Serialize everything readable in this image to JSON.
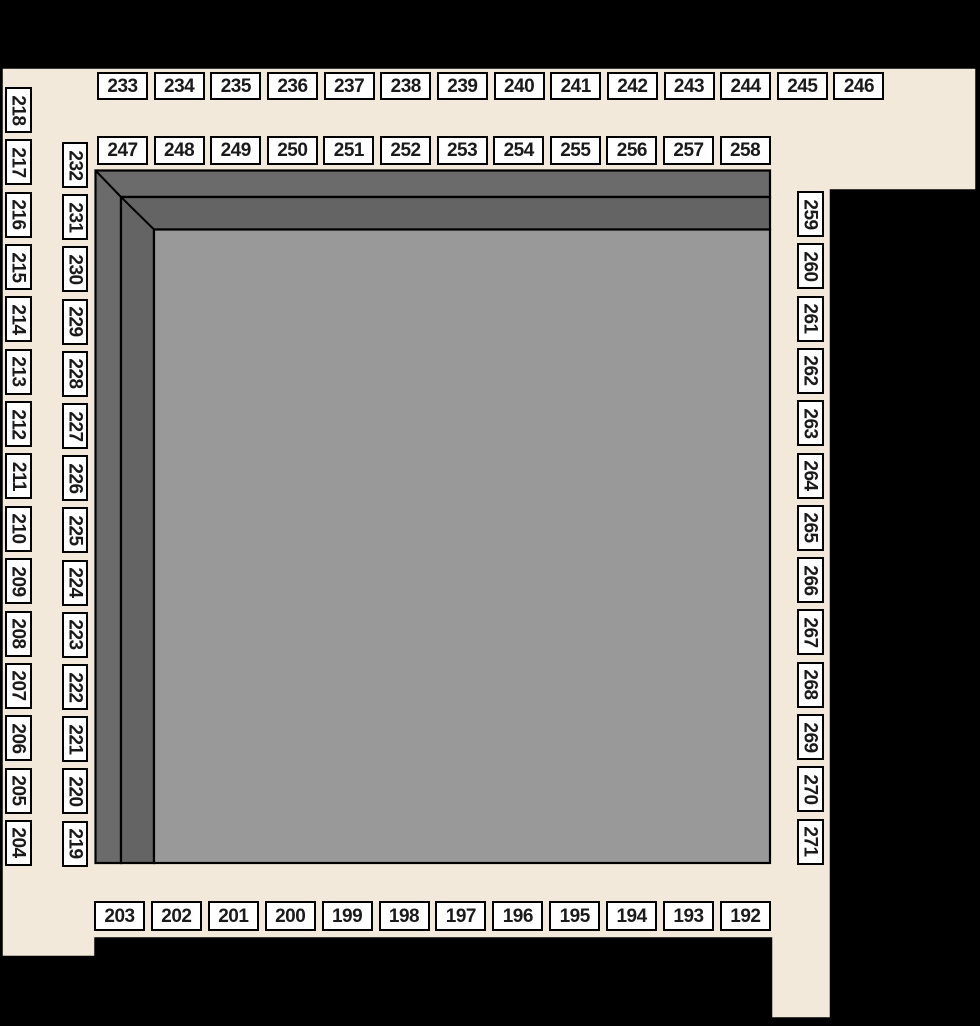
{
  "map_title": "venue-seating-map",
  "colors": {
    "background": "#000000",
    "concourse": "#f2e9da",
    "section_fill": "#ffffff",
    "section_border": "#000000",
    "section_text": "#1a1a1a",
    "wall_outer": "#6b6b6b",
    "wall_inner": "#646464",
    "field": "#999999",
    "outline": "#000000"
  },
  "sections": {
    "top_outer_row": {
      "labels": [
        "233",
        "234",
        "235",
        "236",
        "237",
        "238",
        "239",
        "240",
        "241",
        "242",
        "243",
        "244",
        "245",
        "246"
      ]
    },
    "top_inner_row": {
      "labels": [
        "247",
        "248",
        "249",
        "250",
        "251",
        "252",
        "253",
        "254",
        "255",
        "256",
        "257",
        "258"
      ]
    },
    "left_outer_column": {
      "labels": [
        "218",
        "217",
        "216",
        "215",
        "214",
        "213",
        "212",
        "211",
        "210",
        "209",
        "208",
        "207",
        "206",
        "205",
        "204"
      ]
    },
    "left_inner_column": {
      "labels": [
        "232",
        "231",
        "230",
        "229",
        "228",
        "227",
        "226",
        "225",
        "224",
        "223",
        "222",
        "221",
        "220",
        "219"
      ]
    },
    "right_column": {
      "labels": [
        "259",
        "260",
        "261",
        "262",
        "263",
        "264",
        "265",
        "266",
        "267",
        "268",
        "269",
        "270",
        "271"
      ]
    },
    "bottom_row": {
      "labels": [
        "203",
        "202",
        "201",
        "200",
        "199",
        "198",
        "197",
        "196",
        "195",
        "194",
        "193",
        "192"
      ]
    }
  }
}
